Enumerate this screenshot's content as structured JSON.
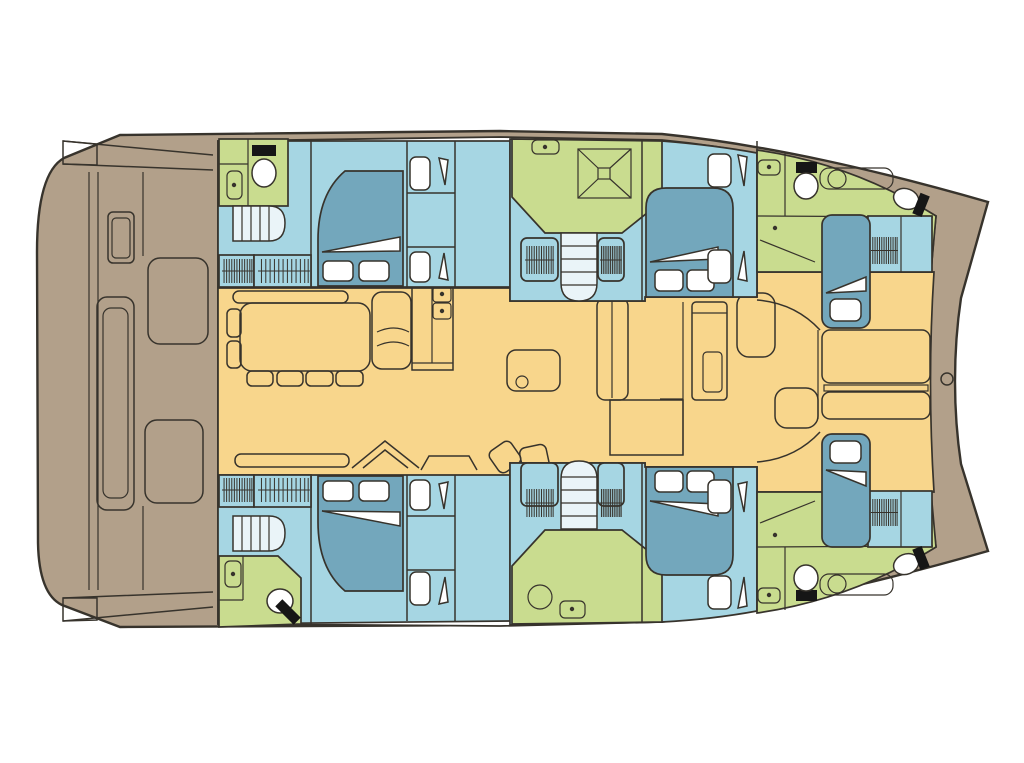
{
  "diagram": {
    "type": "catamaran yacht floor plan, top view, bow to the right",
    "colors": {
      "background": "#ffffff",
      "deck": "#b2a08a",
      "salon": "#f8d68c",
      "cabin": "#a6d6e3",
      "bed": "#73a7bc",
      "bathroom": "#c9dc8f",
      "stairs": "#eaf4f8",
      "furniture_white": "#ffffff",
      "black_fixture": "#161616",
      "outline": "#37332c"
    },
    "regions": [
      {
        "id": "aft-deck",
        "name": "aft cockpit deck",
        "color_key": "deck"
      },
      {
        "id": "salon",
        "name": "salon and galley",
        "color_key": "salon"
      },
      {
        "id": "port-aft-cabin",
        "name": "port aft double cabin",
        "color_key": "cabin"
      },
      {
        "id": "port-aft-bathroom",
        "name": "port aft bathroom",
        "color_key": "bathroom"
      },
      {
        "id": "port-mid-shower",
        "name": "port shower room",
        "color_key": "bathroom"
      },
      {
        "id": "port-mid-cabin",
        "name": "port forward double cabin",
        "color_key": "cabin"
      },
      {
        "id": "port-bow-bathroom",
        "name": "port bow bathroom",
        "color_key": "bathroom"
      },
      {
        "id": "port-bow-berth",
        "name": "port bow single berth",
        "color_key": "cabin"
      },
      {
        "id": "starboard-aft-cabin",
        "name": "starboard aft double cabin",
        "color_key": "cabin"
      },
      {
        "id": "starboard-aft-bathroom",
        "name": "starboard aft bathroom",
        "color_key": "bathroom"
      },
      {
        "id": "starboard-mid-shower",
        "name": "starboard shower room",
        "color_key": "bathroom"
      },
      {
        "id": "starboard-mid-cabin",
        "name": "starboard forward double cabin",
        "color_key": "cabin"
      },
      {
        "id": "starboard-bow-bathroom",
        "name": "starboard bow bathroom",
        "color_key": "bathroom"
      },
      {
        "id": "starboard-bow-berth",
        "name": "starboard bow single berth",
        "color_key": "cabin"
      },
      {
        "id": "bow-lounge",
        "name": "bow lounge pads",
        "color_key": "salon"
      }
    ],
    "icons": [
      "double-bed-icon",
      "single-bed-icon",
      "pillow-icon",
      "blanket-fold-icon",
      "toilet-icon",
      "sink-icon",
      "washbasin-icon",
      "shower-icon",
      "stairs-icon",
      "hanging-locker-icon",
      "dining-table-icon",
      "chair-icon",
      "sofa-icon",
      "galley-sink-icon",
      "galley-island-icon",
      "bow-hatch-icon",
      "cockpit-bench-icon",
      "helm-seat-icon"
    ]
  }
}
